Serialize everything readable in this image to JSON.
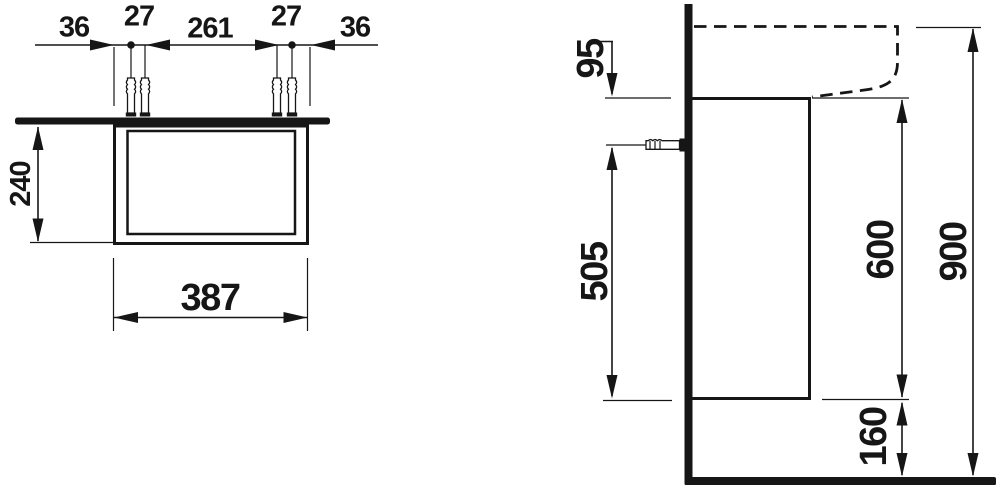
{
  "drawing": {
    "front_view": {
      "offset_left": "36",
      "anchor_pitch_left": "27",
      "anchor_span": "261",
      "anchor_pitch_right": "27",
      "offset_right": "36",
      "cabinet_height": "240",
      "cabinet_width": "387"
    },
    "side_view": {
      "rim_to_cabinet_top": "95",
      "anchor_above_cabinet_bottom": "505",
      "cabinet_depth_height": "600",
      "overall_height": "900",
      "floor_clearance": "160"
    },
    "colors": {
      "ink": "#161616",
      "background": "#ffffff"
    }
  }
}
